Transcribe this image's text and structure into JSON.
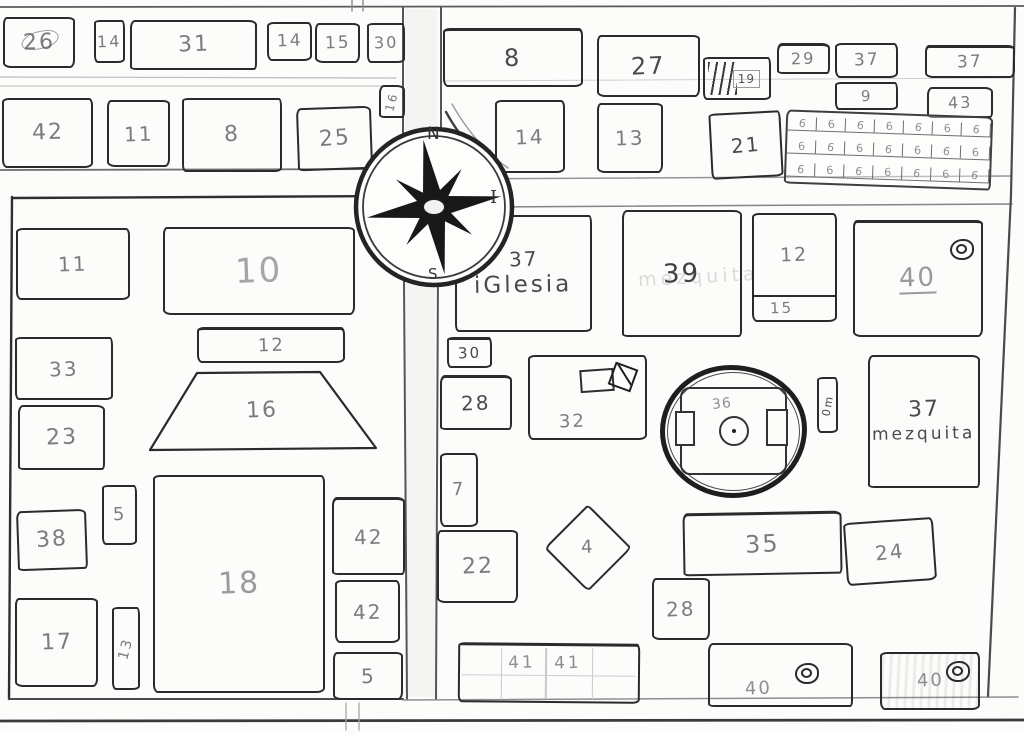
{
  "map": {
    "canvas": {
      "w": 1024,
      "h": 734,
      "paper": "#fcfcfb"
    },
    "ink": {
      "line": "#2b2b2b",
      "label_default": "#7c7c7c",
      "label_dark": "#4a4a4a",
      "label_light": "#9e9e9e"
    },
    "compass": {
      "cx": 434,
      "cy": 207,
      "outer_r": 78,
      "inner_r": 71,
      "long_arm": 68,
      "short_arm": 47,
      "rotation": -9,
      "letters": {
        "north": "N",
        "south": "S",
        "east": "I"
      }
    },
    "road_shades": [
      {
        "x": 405,
        "y": 9,
        "w": 32,
        "h": 123
      },
      {
        "x": 406,
        "y": 283,
        "w": 29,
        "h": 414
      }
    ],
    "streets": [
      {
        "x1": 0,
        "y1": 7,
        "x2": 1024,
        "y2": 6,
        "w": 1.8,
        "c": "#5a5a5a"
      },
      {
        "x1": 352,
        "y1": 0,
        "x2": 352,
        "y2": 11,
        "w": 1.4,
        "c": "#8a8a8a"
      },
      {
        "x1": 363,
        "y1": 0,
        "x2": 363,
        "y2": 11,
        "w": 1.4,
        "c": "#8a8a8a"
      },
      {
        "x1": 0,
        "y1": 77,
        "x2": 396,
        "y2": 78,
        "w": 1.2,
        "c": "#bcbcbc"
      },
      {
        "x1": 0,
        "y1": 86,
        "x2": 396,
        "y2": 86,
        "w": 1.2,
        "c": "#c8c8c8"
      },
      {
        "x1": 443,
        "y1": 81,
        "x2": 1010,
        "y2": 78,
        "w": 1.0,
        "c": "#cfcfcf"
      },
      {
        "x1": 0,
        "y1": 170,
        "x2": 402,
        "y2": 169,
        "w": 1.8,
        "c": "#6e6e6e"
      },
      {
        "x1": 441,
        "y1": 179,
        "x2": 1012,
        "y2": 176,
        "w": 1.5,
        "c": "#949494"
      },
      {
        "x1": 490,
        "y1": 207,
        "x2": 1012,
        "y2": 204,
        "w": 1.5,
        "c": "#858585"
      },
      {
        "x1": 403,
        "y1": 7,
        "x2": 403,
        "y2": 133,
        "w": 2.0,
        "c": "#555555"
      },
      {
        "x1": 441,
        "y1": 7,
        "x2": 441,
        "y2": 140,
        "w": 2.0,
        "c": "#555555"
      },
      {
        "x1": 404,
        "y1": 281,
        "x2": 407,
        "y2": 699,
        "w": 2.0,
        "c": "#555555"
      },
      {
        "x1": 438,
        "y1": 269,
        "x2": 436,
        "y2": 699,
        "w": 2.0,
        "c": "#555555"
      },
      {
        "x1": 12,
        "y1": 198,
        "x2": 400,
        "y2": 196,
        "w": 2.4,
        "c": "#2f2f2f"
      },
      {
        "x1": 12,
        "y1": 197,
        "x2": 9,
        "y2": 699,
        "w": 2.4,
        "c": "#2f2f2f"
      },
      {
        "x1": 9,
        "y1": 699,
        "x2": 403,
        "y2": 699,
        "w": 2.0,
        "c": "#4a4a4a"
      },
      {
        "x1": 403,
        "y1": 700,
        "x2": 1018,
        "y2": 697,
        "w": 1.5,
        "c": "#8f8f8f"
      },
      {
        "x1": 0,
        "y1": 721,
        "x2": 1024,
        "y2": 720,
        "w": 2.8,
        "c": "#3a3a3a"
      },
      {
        "x1": 346,
        "y1": 703,
        "x2": 346,
        "y2": 730,
        "w": 1.3,
        "c": "#a5a5a5"
      },
      {
        "x1": 359,
        "y1": 703,
        "x2": 359,
        "y2": 730,
        "w": 1.3,
        "c": "#a5a5a5"
      },
      {
        "x1": 1015,
        "y1": 8,
        "x2": 1011,
        "y2": 195,
        "w": 2.2,
        "c": "#4a4a4a"
      },
      {
        "x1": 1011,
        "y1": 195,
        "x2": 988,
        "y2": 696,
        "w": 2.2,
        "c": "#4a4a4a"
      }
    ],
    "shapes": [
      {
        "type": "path",
        "d": "M 446,112 Q 468,152 503,175",
        "w": 2.4,
        "c": "#3f3f3f"
      },
      {
        "type": "path",
        "d": "M 452,104 Q 476,146 508,168",
        "w": 1.4,
        "c": "#9a9a9a"
      }
    ],
    "blocks": [
      {
        "id": "26",
        "label": "26",
        "x": 3,
        "y": 17,
        "w": 72,
        "h": 51,
        "fs": 22,
        "scribble": true
      },
      {
        "id": "14a",
        "label": "14",
        "x": 94,
        "y": 20,
        "w": 31,
        "h": 43,
        "fs": 16
      },
      {
        "id": "31",
        "label": "31",
        "x": 130,
        "y": 20,
        "w": 127,
        "h": 50,
        "fs": 22
      },
      {
        "id": "14b",
        "label": "14",
        "x": 267,
        "y": 22,
        "w": 45,
        "h": 39,
        "fs": 17
      },
      {
        "id": "15a",
        "label": "15",
        "x": 315,
        "y": 23,
        "w": 45,
        "h": 40,
        "fs": 17
      },
      {
        "id": "30a",
        "label": "30",
        "x": 367,
        "y": 23,
        "w": 38,
        "h": 40,
        "fs": 16
      },
      {
        "id": "16v",
        "label": "16",
        "x": 379,
        "y": 85,
        "w": 26,
        "h": 33,
        "fs": 12,
        "textRot": -75
      },
      {
        "id": "42a",
        "label": "42",
        "x": 2,
        "y": 98,
        "w": 91,
        "h": 70,
        "fs": 22
      },
      {
        "id": "11a",
        "label": "11",
        "x": 107,
        "y": 100,
        "w": 63,
        "h": 67,
        "fs": 20
      },
      {
        "id": "8a",
        "label": "8",
        "x": 182,
        "y": 98,
        "w": 100,
        "h": 74,
        "fs": 22
      },
      {
        "id": "25",
        "label": "25",
        "x": 297,
        "y": 107,
        "w": 75,
        "h": 63,
        "fs": 22,
        "rot": -2
      },
      {
        "id": "8b",
        "label": "8",
        "x": 443,
        "y": 28,
        "w": 140,
        "h": 59,
        "fs": 24,
        "ink": "#4a4a4a"
      },
      {
        "id": "27",
        "label": "27",
        "x": 597,
        "y": 35,
        "w": 103,
        "h": 62,
        "fs": 24,
        "ink": "#4a4a4a"
      },
      {
        "id": "19",
        "label": "19",
        "x": 703,
        "y": 57,
        "w": 68,
        "h": 43,
        "fs": 12,
        "shape": "stairs"
      },
      {
        "id": "29",
        "label": "29",
        "x": 777,
        "y": 43,
        "w": 53,
        "h": 31,
        "fs": 16
      },
      {
        "id": "37a",
        "label": "37",
        "x": 835,
        "y": 43,
        "w": 63,
        "h": 35,
        "fs": 17
      },
      {
        "id": "37b",
        "label": "37",
        "x": 925,
        "y": 45,
        "w": 90,
        "h": 33,
        "fs": 17
      },
      {
        "id": "9",
        "label": "9",
        "x": 835,
        "y": 82,
        "w": 63,
        "h": 28,
        "fs": 15
      },
      {
        "id": "43",
        "label": "43",
        "x": 927,
        "y": 87,
        "w": 66,
        "h": 31,
        "fs": 16
      },
      {
        "id": "14c",
        "label": "14",
        "x": 495,
        "y": 100,
        "w": 70,
        "h": 73,
        "fs": 20
      },
      {
        "id": "13a",
        "label": "13",
        "x": 597,
        "y": 103,
        "w": 66,
        "h": 70,
        "fs": 20
      },
      {
        "id": "21",
        "label": "21",
        "x": 710,
        "y": 112,
        "w": 72,
        "h": 66,
        "fs": 20,
        "rot": -3,
        "ink": "#4a4a4a"
      },
      {
        "id": "grid6",
        "x": 785,
        "y": 113,
        "w": 207,
        "h": 74,
        "shape": "grid",
        "rows": 3,
        "cols": 7,
        "cell": "6",
        "rot": 2,
        "fs": 11
      },
      {
        "id": "11b",
        "label": "11",
        "x": 16,
        "y": 228,
        "w": 114,
        "h": 72,
        "fs": 20
      },
      {
        "id": "10",
        "label": "10",
        "x": 163,
        "y": 227,
        "w": 192,
        "h": 88,
        "fs": 34,
        "ink": "#a6a6a6"
      },
      {
        "id": "33",
        "label": "33",
        "x": 15,
        "y": 337,
        "w": 98,
        "h": 63,
        "fs": 20
      },
      {
        "id": "23",
        "label": "23",
        "x": 18,
        "y": 405,
        "w": 87,
        "h": 65,
        "fs": 22
      },
      {
        "id": "12w",
        "label": "12",
        "x": 197,
        "y": 327,
        "w": 148,
        "h": 36,
        "fs": 18
      },
      {
        "id": "16t",
        "label": "16",
        "x": 148,
        "y": 371,
        "w": 228,
        "h": 79,
        "fs": 22,
        "shape": "trapezoid",
        "inset_l": 49,
        "inset_r": 56
      },
      {
        "id": "5a",
        "label": "5",
        "x": 102,
        "y": 485,
        "w": 35,
        "h": 60,
        "fs": 18
      },
      {
        "id": "38",
        "label": "38",
        "x": 17,
        "y": 510,
        "w": 70,
        "h": 60,
        "fs": 22,
        "rot": -2
      },
      {
        "id": "18",
        "label": "18",
        "x": 153,
        "y": 475,
        "w": 172,
        "h": 218,
        "fs": 30,
        "ink": "#9b9b9b"
      },
      {
        "id": "17",
        "label": "17",
        "x": 15,
        "y": 598,
        "w": 83,
        "h": 89,
        "fs": 22
      },
      {
        "id": "13v",
        "label": "13",
        "x": 112,
        "y": 607,
        "w": 28,
        "h": 83,
        "fs": 14,
        "textRot": -75
      },
      {
        "id": "42b",
        "label": "42",
        "x": 332,
        "y": 497,
        "w": 73,
        "h": 78,
        "fs": 20
      },
      {
        "id": "42c",
        "label": "42",
        "x": 335,
        "y": 580,
        "w": 65,
        "h": 63,
        "fs": 20
      },
      {
        "id": "5b",
        "label": "5",
        "x": 333,
        "y": 652,
        "w": 70,
        "h": 48,
        "fs": 20
      },
      {
        "id": "iglesia",
        "label": "37",
        "sub": "iGlesia",
        "x": 455,
        "y": 215,
        "w": 137,
        "h": 117,
        "fs": 20,
        "subFs": 23,
        "ink": "#4a4a4a"
      },
      {
        "id": "39",
        "label": "39",
        "x": 622,
        "y": 210,
        "w": 120,
        "h": 127,
        "fs": 26,
        "ink": "#3f3f3f",
        "faint": "mezquita"
      },
      {
        "id": "12e",
        "label": "12",
        "sub2": "15",
        "x": 752,
        "y": 213,
        "w": 85,
        "h": 109,
        "divider": 25,
        "fs": 19
      },
      {
        "id": "40a",
        "label": "40",
        "x": 853,
        "y": 220,
        "w": 130,
        "h": 117,
        "fs": 26,
        "ink": "#9a9a9a",
        "underline": true,
        "doodle": {
          "type": "spiral",
          "dx": 95,
          "dy": 16
        }
      },
      {
        "id": "30b",
        "label": "30",
        "x": 447,
        "y": 337,
        "w": 45,
        "h": 31,
        "fs": 15,
        "ink": "#4a4a4a"
      },
      {
        "id": "28a",
        "label": "28",
        "x": 440,
        "y": 375,
        "w": 72,
        "h": 55,
        "fs": 20,
        "ink": "#4a4a4a"
      },
      {
        "id": "32",
        "label": "32",
        "x": 528,
        "y": 355,
        "w": 119,
        "h": 85,
        "fs": 18,
        "labelPos": "bl",
        "doodle": {
          "type": "bed",
          "dx": 50,
          "dy": 12
        }
      },
      {
        "id": "36",
        "label": "36",
        "x": 660,
        "y": 365,
        "w": 147,
        "h": 133,
        "fs": 14,
        "shape": "stadium"
      },
      {
        "id": "0m",
        "label": "0m",
        "x": 817,
        "y": 377,
        "w": 21,
        "h": 56,
        "fs": 11,
        "textRot": -80,
        "ink": "#4a4a4a"
      },
      {
        "id": "mezquita",
        "label": "37",
        "sub": "mezquita",
        "x": 868,
        "y": 355,
        "w": 112,
        "h": 133,
        "fs": 22,
        "subFs": 17,
        "ink": "#4a4a4a"
      },
      {
        "id": "7",
        "label": "7",
        "x": 440,
        "y": 453,
        "w": 38,
        "h": 74,
        "fs": 18
      },
      {
        "id": "22",
        "label": "22",
        "x": 437,
        "y": 530,
        "w": 81,
        "h": 73,
        "fs": 22
      },
      {
        "id": "4",
        "label": "4",
        "x": 557,
        "y": 517,
        "w": 62,
        "h": 62,
        "fs": 18,
        "shape": "diamond"
      },
      {
        "id": "35",
        "label": "35",
        "x": 683,
        "y": 512,
        "w": 159,
        "h": 63,
        "fs": 24,
        "rot": -1
      },
      {
        "id": "24",
        "label": "24",
        "x": 845,
        "y": 520,
        "w": 90,
        "h": 63,
        "fs": 20,
        "rot": -4
      },
      {
        "id": "28b",
        "label": "28",
        "x": 652,
        "y": 578,
        "w": 58,
        "h": 62,
        "fs": 20
      },
      {
        "id": "41",
        "x": 458,
        "y": 643,
        "w": 182,
        "h": 60,
        "shape": "grid41",
        "labels": [
          "41",
          "41"
        ],
        "fs": 17,
        "rot": 0.5
      },
      {
        "id": "40b",
        "label": "40",
        "x": 708,
        "y": 643,
        "w": 145,
        "h": 64,
        "fs": 18,
        "ink": "#8f8f8f",
        "labelPos": "bl",
        "doodle": {
          "type": "spiral",
          "dx": 85,
          "dy": 18
        }
      },
      {
        "id": "40c",
        "label": "40",
        "x": 880,
        "y": 652,
        "w": 100,
        "h": 58,
        "fs": 18,
        "ink": "#8f8f8f",
        "shaded": true,
        "doodle": {
          "type": "spiral",
          "dx": 64,
          "dy": 7
        }
      }
    ]
  }
}
